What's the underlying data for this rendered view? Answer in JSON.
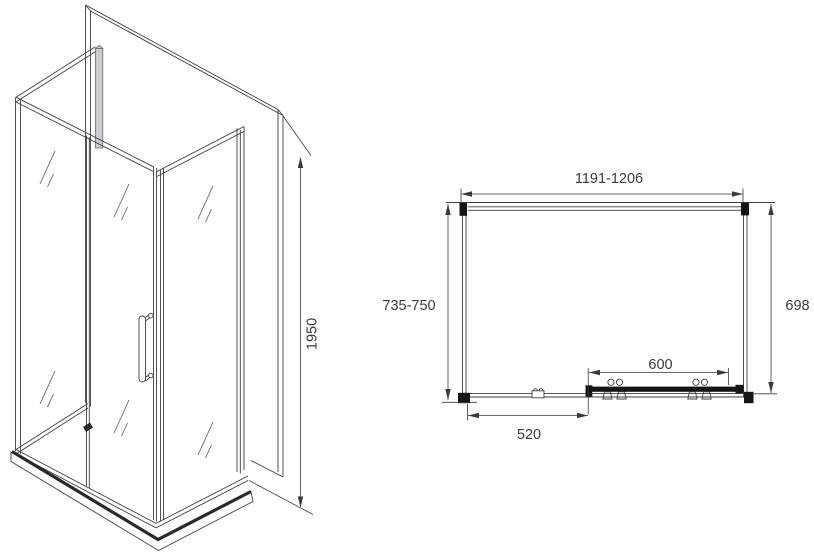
{
  "dimensions": {
    "height": "1950",
    "width_range": "1191-1206",
    "left_depth_range": "735-750",
    "right_depth": "698",
    "door_width": "600",
    "fixed_panel_width": "520"
  },
  "colors": {
    "line": "#3f3f3f",
    "text": "#3a3a3a",
    "profile_black": "#151515",
    "corner_profile_gray": "#c9ccce",
    "background": "#ffffff"
  }
}
